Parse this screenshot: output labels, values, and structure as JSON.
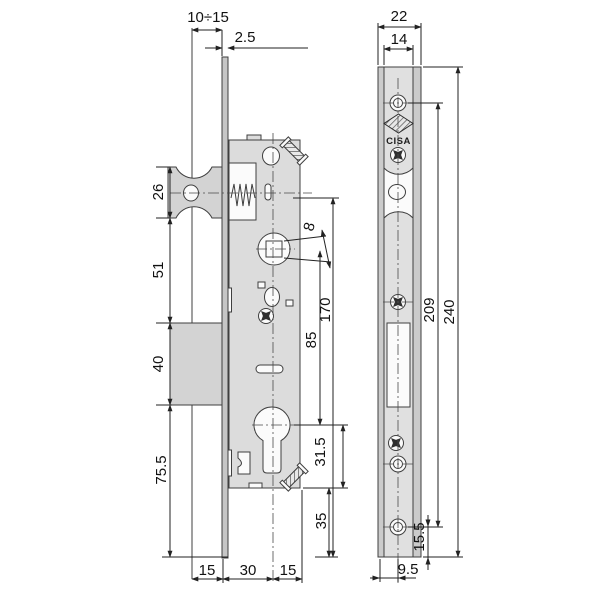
{
  "brand": {
    "name": "CISA"
  },
  "dims": {
    "gap_range": "10÷15",
    "plate_thickness": "2.5",
    "latch_height": "26",
    "latch_to_deadbolt": "51",
    "deadbolt_height": "40",
    "deadbolt_to_end": "75.5",
    "follower_square": "8",
    "case_height": "170",
    "centre_distance": "85",
    "cylinder_to_case_bottom": "31.5",
    "case_bottom_to_end": "35",
    "flange_left": "15",
    "backset": "30",
    "case_rear": "15",
    "faceplate_width": "22",
    "channel_width": "14",
    "screw_distance": "209",
    "faceplate_length": "240",
    "hole_to_end": "15.5",
    "axis_offset": "9.5"
  }
}
